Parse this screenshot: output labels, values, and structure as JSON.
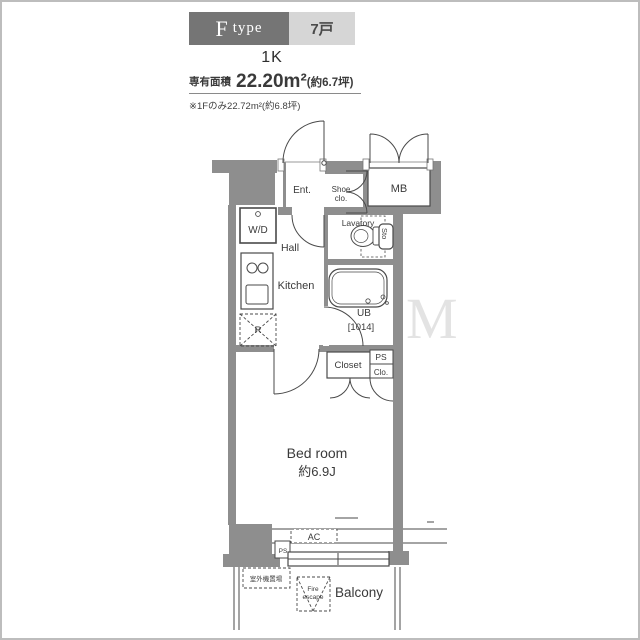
{
  "header": {
    "type_letter": "F",
    "type_word": "type",
    "unit_count": "7戸",
    "plan_type": "1K",
    "area_label": "専有面積",
    "area_value": "22.20m²",
    "area_tsubo": "(約6.7坪)",
    "note": "※1Fのみ22.72m²(約6.8坪)"
  },
  "plan": {
    "entrance": "Ent.",
    "shoe_closet_line1": "Shoe",
    "shoe_closet_line2": "clo.",
    "meter_box": "MB",
    "washer_dryer": "W/D",
    "hall": "Hall",
    "lavatory": "Lavatory",
    "storage": "Sto",
    "kitchen": "Kitchen",
    "refrigerator": "R",
    "unit_bath": "UB",
    "unit_bath_size": "[1014]",
    "closet": "Closet",
    "pipe_space": "PS",
    "closet_small": "Clo.",
    "bedroom": "Bed room",
    "bedroom_size": "約6.9J",
    "air_conditioner": "AC",
    "pipe_space_bottom": "PS",
    "outdoor_unit_space": "室外機置場",
    "fire_escape_line1": "Fire",
    "fire_escape_line2": "escape",
    "balcony": "Balcony"
  },
  "watermark": "M",
  "colors": {
    "wall": "#8e8e8e",
    "line": "#4a4a4a",
    "header_dark": "#757575",
    "header_light": "#d6d6d6",
    "frame": "#bdbdbd"
  }
}
